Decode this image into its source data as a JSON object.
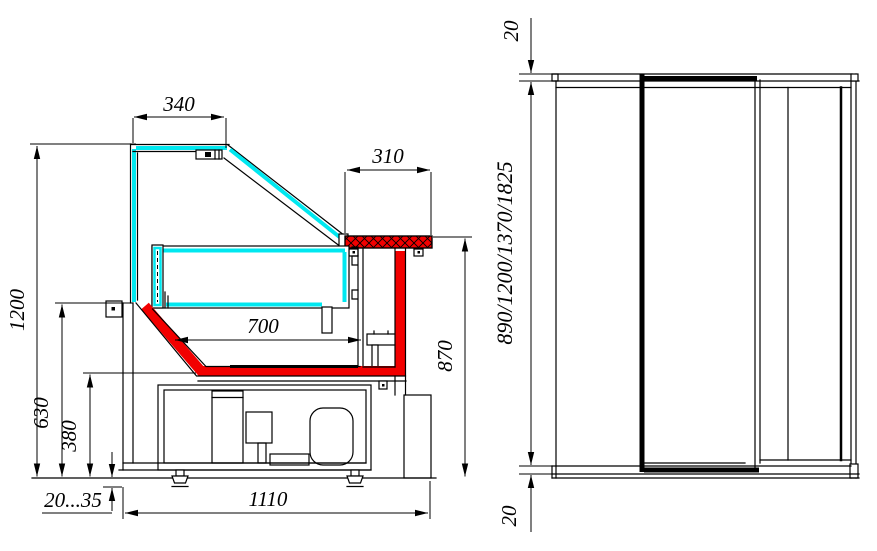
{
  "drawing": {
    "colors": {
      "glass": "#00e8f0",
      "accent": "#f20000",
      "line": "#000000",
      "paper": "#ffffff"
    },
    "side_view": {
      "dim_canopy_width": "340",
      "dim_worktop_depth": "310",
      "dim_overall_height": "1200",
      "dim_basin_front_height": "630",
      "dim_basin_bottom_height": "380",
      "dim_deck_width": "700",
      "dim_worktop_height": "870",
      "dim_foot_range": "20...35",
      "dim_overall_depth": "1110"
    },
    "front_view": {
      "dim_top_thickness": "20",
      "dim_lengths": "890/1200/1370/1825",
      "dim_bottom_thickness": "20"
    }
  }
}
